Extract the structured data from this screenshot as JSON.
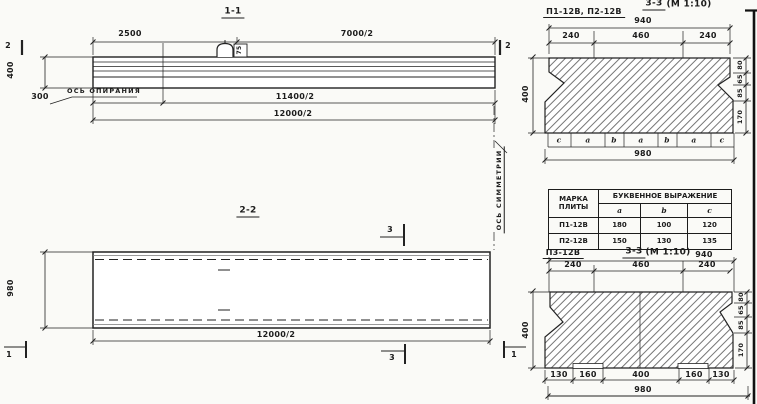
{
  "s11": {
    "title": "1-1",
    "dim_2500": "2500",
    "dim_7000_2": "7000/2",
    "marker_2": "2",
    "dim_400": "400",
    "dim_300": "300",
    "support_axis_label": "ОСЬ ОПИРАНИЯ",
    "dim_11400_2": "11400/2",
    "dim_12000_2": "12000/2",
    "loop_tag": "75"
  },
  "s22": {
    "title": "2-2",
    "dim_980": "980",
    "dim_12000_2": "12000/2",
    "marker_3": "3",
    "marker_1": "1",
    "symmetry_axis_label": "ОСЬ СИММЕТРИИ"
  },
  "s33_top": {
    "plates_label": "П1-12В, П2-12В",
    "title": "3-3",
    "scale": "(М 1:10)",
    "dim_940": "940",
    "dims_top": [
      "240",
      "460",
      "240"
    ],
    "dim_400": "400",
    "dims_right": [
      "80",
      "65",
      "85",
      "170"
    ],
    "letters": [
      "c",
      "a",
      "b",
      "a",
      "b",
      "a",
      "c"
    ],
    "dim_980": "980"
  },
  "table": {
    "col_mark": "МАРКА ПЛИТЫ",
    "col_expression": "БУКВЕННОЕ ВЫРАЖЕНИЕ",
    "subheaders": [
      "a",
      "b",
      "c"
    ],
    "rows": [
      [
        "П1-12В",
        "180",
        "100",
        "120"
      ],
      [
        "П2-12В",
        "150",
        "130",
        "135"
      ]
    ]
  },
  "s33_bottom": {
    "plate_label": "П3-12В",
    "title": "3-3",
    "scale": "(М 1:10)",
    "dim_940": "940",
    "dims_top": [
      "240",
      "460",
      "240"
    ],
    "dim_400": "400",
    "dims_right": [
      "80",
      "65",
      "85",
      "170"
    ],
    "dims_bottom": [
      "130",
      "160",
      "400",
      "160",
      "130"
    ],
    "dim_980": "980"
  }
}
